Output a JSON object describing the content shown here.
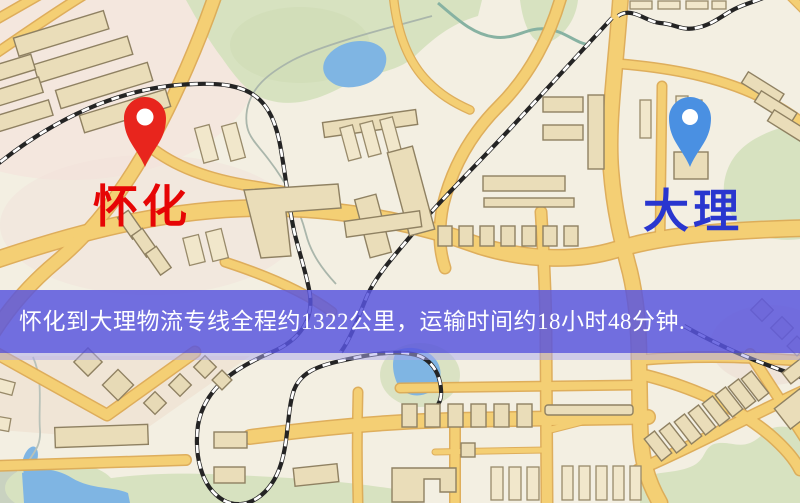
{
  "banner": {
    "text": "怀化到大理物流专线全程约1322公里，运输时间约18小时48分钟.",
    "background_color": "#5855de",
    "text_color": "#ffffff"
  },
  "route": {
    "origin": "怀化",
    "destination": "大理",
    "distance_text": "约1322公里",
    "duration_text": "约18小时48分钟"
  },
  "markers": {
    "origin": {
      "label": "怀化",
      "label_color": "#e60505",
      "pin_color": "#e8251d"
    },
    "destination": {
      "label": "大理",
      "label_color": "#2936cf",
      "pin_color": "#4a90e2"
    }
  },
  "map": {
    "style": "street-map",
    "colors": {
      "background": "#f3efe2",
      "road_fill": "#f4cf74",
      "road_casing": "#dcaa54",
      "park": "#d7e2c0",
      "water": "#7fb5e3",
      "building": "#eaddb9",
      "railway": "#242424"
    }
  }
}
